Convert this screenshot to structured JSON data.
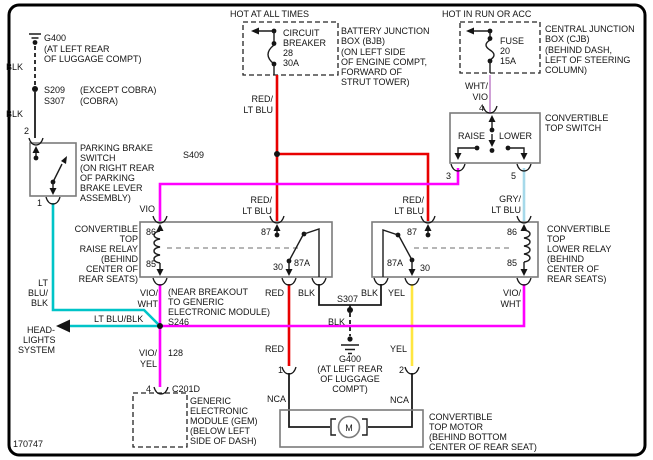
{
  "colors": {
    "red": "#e80000",
    "violet": "#ff00ff",
    "cyan": "#00c4c8",
    "yellow": "#ffe640",
    "pale_blue": "#a6d9ea",
    "pale_violet": "#cfa0d6",
    "black_wire": "#1c1c1c"
  },
  "frame": {
    "id": "170747"
  },
  "bjb": {
    "hot": "HOT AT ALL TIMES",
    "device": [
      "CIRCUIT",
      "BREAKER",
      "28",
      "30A"
    ],
    "note": [
      "BATTERY JUNCTION",
      "BOX (BJB)",
      "(ON LEFT SIDE",
      "OF ENGINE COMPT,",
      "FORWARD OF",
      "STRUT TOWER)"
    ]
  },
  "cjb": {
    "hot": "HOT IN RUN OR ACC",
    "device": [
      "FUSE",
      "20",
      "15A"
    ],
    "note": [
      "CENTRAL JUNCTION",
      "BOX (CJB)",
      "(BEHIND DASH,",
      "LEFT OF STEERING",
      "COLUMN)"
    ]
  },
  "ground_top": {
    "name": "G400",
    "note": [
      "(AT LEFT REAR",
      "OF LUGGAGE COMPT)"
    ]
  },
  "splice_s209": {
    "name": "S209",
    "note": "(EXCEPT COBRA)"
  },
  "splice_s307a": {
    "name": "S307",
    "note": "(COBRA)"
  },
  "splice_s409": {
    "name": "S409"
  },
  "splice_s246": {
    "name": "S246",
    "note": [
      "(NEAR BREAKOUT",
      "TO GENERIC",
      "ELECTRONIC MODULE)"
    ]
  },
  "splice_s307b": {
    "name": "S307"
  },
  "ground_bottom": {
    "name": "G400",
    "note": [
      "(AT LEFT REAR",
      "OF LUGGAGE",
      "COMPT)"
    ]
  },
  "parking_brake": {
    "pin_top": "2",
    "pin_bottom": "1",
    "note": [
      "PARKING BRAKE",
      "SWITCH",
      "(ON RIGHT REAR",
      "OF PARKING",
      "BRAKE LEVER",
      "ASSEMBLY)"
    ]
  },
  "top_switch": {
    "pin_in": "4",
    "pin_raise": "3",
    "pin_lower": "5",
    "raise": "RAISE",
    "lower": "LOWER",
    "note": [
      "CONVERTIBLE",
      "TOP SWITCH"
    ]
  },
  "raise_relay": {
    "p86": "86",
    "p85": "85",
    "p87": "87",
    "p30": "30",
    "p87a": "87A",
    "note": [
      "CONVERTIBLE",
      "TOP",
      "RAISE RELAY",
      "(BEHIND",
      "CENTER OF",
      "REAR SEATS)"
    ]
  },
  "lower_relay": {
    "p86": "86",
    "p85": "85",
    "p87": "87",
    "p30": "30",
    "p87a": "87A",
    "note": [
      "CONVERTIBLE",
      "TOP",
      "LOWER RELAY",
      "(BEHIND",
      "CENTER OF",
      "REAR SEATS)"
    ]
  },
  "gem": {
    "pin": "4",
    "connector": "C201D",
    "circuit": "128",
    "note": [
      "GENERIC",
      "ELECTRONIC",
      "MODULE (GEM)",
      "(BELOW LEFT",
      "SIDE OF DASH)"
    ]
  },
  "motor": {
    "pin_left": "1",
    "pin_right": "2",
    "symbol": "M",
    "nca": "NCA",
    "note": [
      "CONVERTIBLE",
      "TOP MOTOR",
      "(BEHIND BOTTOM",
      "CENTER OF REAR SEAT)"
    ]
  },
  "headlights": {
    "note": [
      "HEAD-",
      "LIGHTS",
      "SYSTEM"
    ]
  },
  "wire_labels": {
    "blk": "BLK",
    "red": "RED",
    "yel": "YEL",
    "vio": "VIO",
    "wht": "WHT",
    "red_s": "RED/",
    "lt_blu": "LT BLU",
    "wht_s": "WHT/",
    "gry_s": "GRY/",
    "vio_s": "VIO/",
    "lt": "LT",
    "blu_s": "BLU/",
    "lt_blu_blk": "LT BLU/BLK"
  }
}
